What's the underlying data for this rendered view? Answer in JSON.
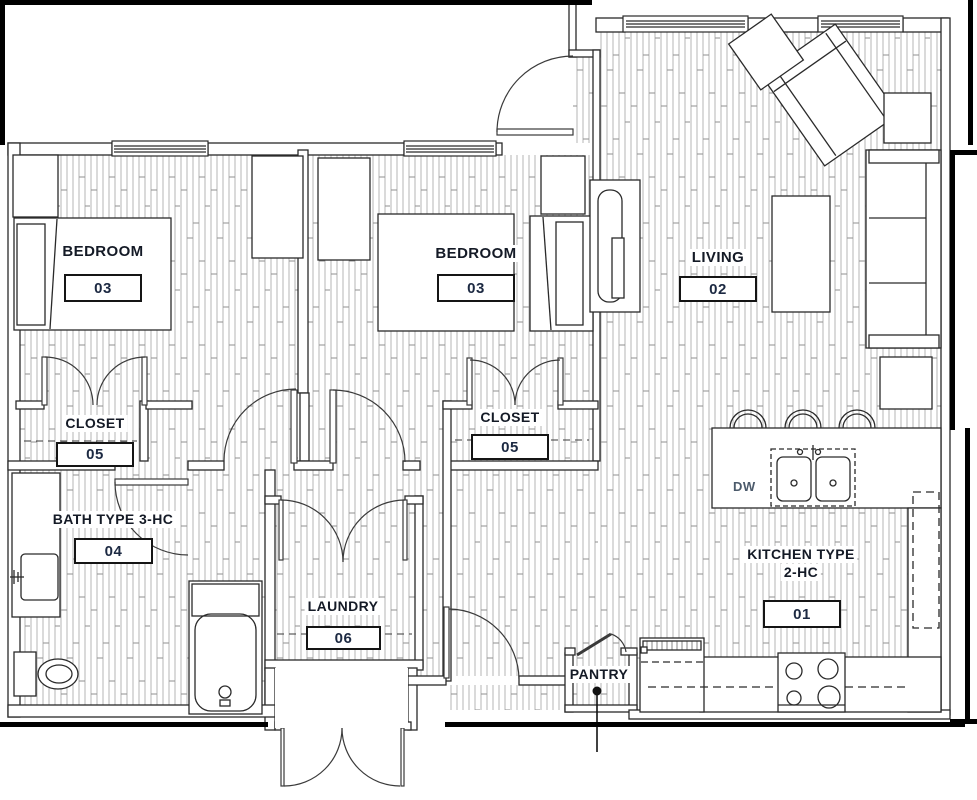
{
  "drawing": {
    "type": "apartment floor plan",
    "rooms": {
      "bedroom1": {
        "name": "BEDROOM",
        "number": "03"
      },
      "bedroom2": {
        "name": "BEDROOM",
        "number": "03"
      },
      "living": {
        "name": "LIVING",
        "number": "02"
      },
      "closet1": {
        "name": "CLOSET",
        "number": "05"
      },
      "closet2": {
        "name": "CLOSET",
        "number": "05"
      },
      "bath": {
        "name": "BATH TYPE 3-HC",
        "number": "04"
      },
      "laundry": {
        "name": "LAUNDRY",
        "number": "06"
      },
      "kitchen": {
        "name_line1": "KITCHEN TYPE",
        "name_line2": "2-HC",
        "number": "01"
      },
      "pantry": {
        "name": "PANTRY"
      }
    },
    "annotations": {
      "dishwasher": "DW"
    },
    "colors": {
      "line": "#2a2a2a",
      "heavy_line": "#000000",
      "hatch": "#a8a8a8",
      "room_name": "#141a26",
      "room_number": "#1c2942",
      "dw_text": "#4b5a6b"
    }
  }
}
